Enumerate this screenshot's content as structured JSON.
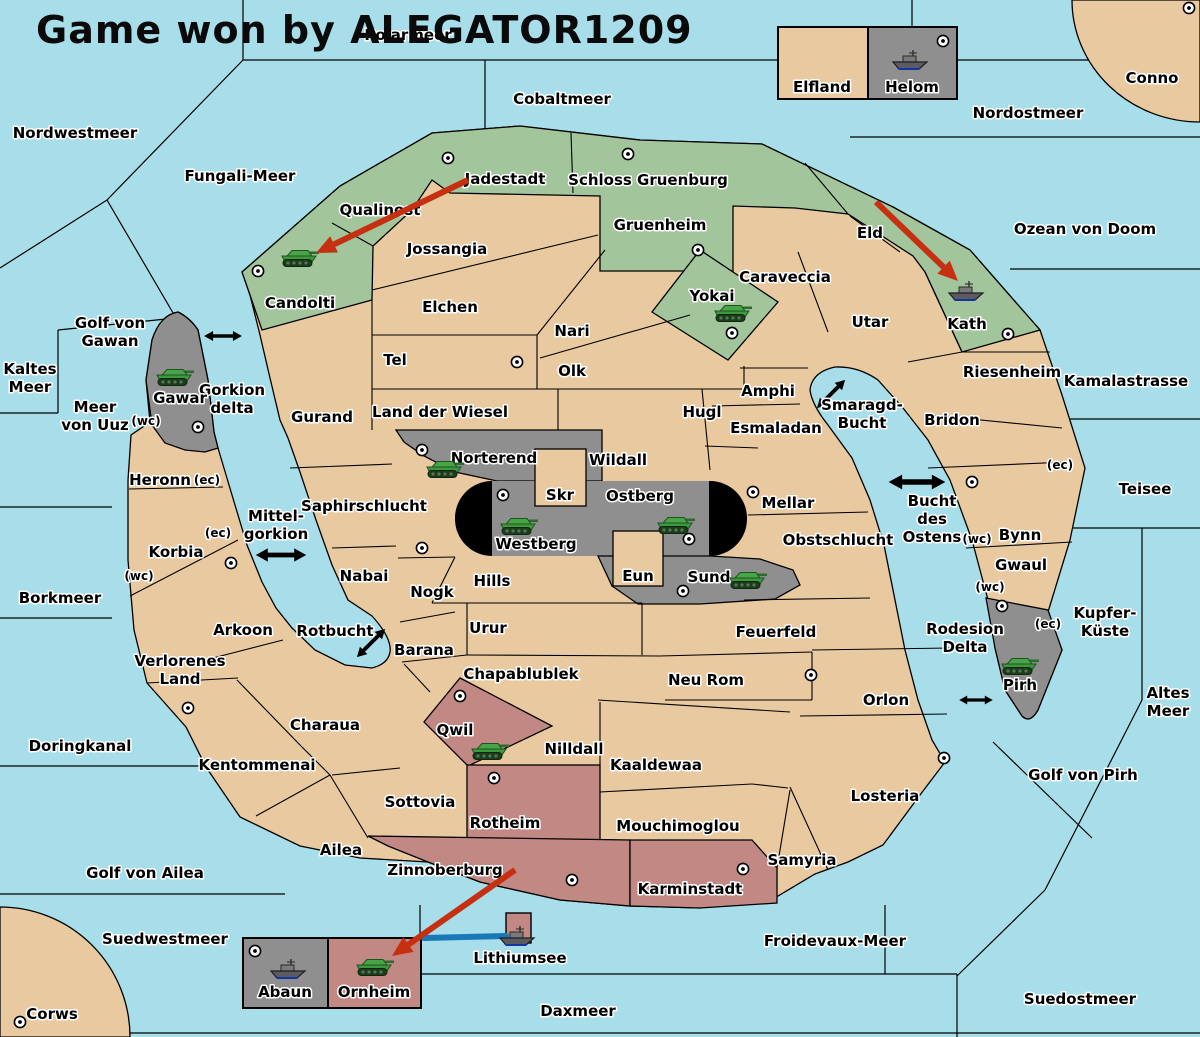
{
  "title": "Game won by ALEGATOR1209",
  "colors": {
    "sea": "#A8DEEA",
    "land": "#E9C9A0",
    "green": "#A2C59C",
    "gray": "#8F8F8F",
    "pink": "#C28884",
    "black_tunnel": "#000000",
    "arrow_red": "#C62F10",
    "link_blue": "#1878B8",
    "border": "#000000"
  },
  "sea_labels": [
    {
      "name": "polarmeer",
      "x": 408,
      "y": 40,
      "lines": [
        "Polarmeer"
      ]
    },
    {
      "name": "nordwestmeer",
      "x": 75,
      "y": 138,
      "lines": [
        "Nordwestmeer"
      ]
    },
    {
      "name": "fungali-meer",
      "x": 240,
      "y": 181,
      "lines": [
        "Fungali-Meer"
      ]
    },
    {
      "name": "cobaltmeer",
      "x": 562,
      "y": 104,
      "lines": [
        "Cobaltmeer"
      ]
    },
    {
      "name": "nordostmeer",
      "x": 1028,
      "y": 118,
      "lines": [
        "Nordostmeer"
      ]
    },
    {
      "name": "conno",
      "x": 1152,
      "y": 83,
      "lines": [
        "Conno"
      ]
    },
    {
      "name": "ozean-von-doom",
      "x": 1085,
      "y": 234,
      "lines": [
        "Ozean von Doom"
      ]
    },
    {
      "name": "kamalastrasse",
      "x": 1126,
      "y": 386,
      "lines": [
        "Kamalastrasse"
      ]
    },
    {
      "name": "teisee",
      "x": 1145,
      "y": 494,
      "lines": [
        "Teisee"
      ]
    },
    {
      "name": "kupfer-kueste",
      "x": 1105,
      "y": 618,
      "lines": [
        "Kupfer-",
        "Küste"
      ]
    },
    {
      "name": "altes-meer",
      "x": 1168,
      "y": 698,
      "lines": [
        "Altes",
        "Meer"
      ]
    },
    {
      "name": "golf-von-pirh",
      "x": 1083,
      "y": 780,
      "lines": [
        "Golf von Pirh"
      ]
    },
    {
      "name": "golf-von-gawan",
      "x": 110,
      "y": 328,
      "lines": [
        "Golf von",
        "Gawan"
      ]
    },
    {
      "name": "kaltes-meer",
      "x": 30,
      "y": 374,
      "lines": [
        "Kaltes",
        "Meer"
      ]
    },
    {
      "name": "meer-von-uuz",
      "x": 95,
      "y": 412,
      "lines": [
        "Meer",
        "von Uuz"
      ]
    },
    {
      "name": "borkmeer",
      "x": 60,
      "y": 603,
      "lines": [
        "Borkmeer"
      ]
    },
    {
      "name": "doringkanal",
      "x": 80,
      "y": 751,
      "lines": [
        "Doringkanal"
      ]
    },
    {
      "name": "golf-von-ailea",
      "x": 145,
      "y": 878,
      "lines": [
        "Golf von Ailea"
      ]
    },
    {
      "name": "suedwestmeer",
      "x": 165,
      "y": 944,
      "lines": [
        "Suedwestmeer"
      ]
    },
    {
      "name": "corws",
      "x": 52,
      "y": 1019,
      "lines": [
        "Corws"
      ]
    },
    {
      "name": "daxmeer",
      "x": 578,
      "y": 1016,
      "lines": [
        "Daxmeer"
      ]
    },
    {
      "name": "suedostmeer",
      "x": 1080,
      "y": 1004,
      "lines": [
        "Suedostmeer"
      ]
    },
    {
      "name": "froidevaux-meer",
      "x": 835,
      "y": 946,
      "lines": [
        "Froidevaux-Meer"
      ]
    },
    {
      "name": "lithiumsee",
      "x": 520,
      "y": 963,
      "lines": [
        "Lithiumsee"
      ]
    },
    {
      "name": "gorkion-delta",
      "x": 232,
      "y": 395,
      "lines": [
        "Gorkion",
        "delta"
      ]
    },
    {
      "name": "mittel-gorkion",
      "x": 276,
      "y": 521,
      "lines": [
        "Mittel-",
        "gorkion"
      ]
    },
    {
      "name": "rotbucht",
      "x": 335,
      "y": 636,
      "lines": [
        "Rotbucht"
      ]
    },
    {
      "name": "smaragd-bucht",
      "x": 862,
      "y": 410,
      "lines": [
        "Smaragd-",
        "Bucht"
      ]
    },
    {
      "name": "bucht-des-ostens",
      "x": 932,
      "y": 506,
      "lines": [
        "Bucht",
        "des",
        "Ostens"
      ]
    },
    {
      "name": "rodesion-delta",
      "x": 965,
      "y": 634,
      "lines": [
        "Rodesion",
        "Delta"
      ]
    }
  ],
  "land_labels": [
    {
      "name": "candolti",
      "x": 300,
      "y": 308,
      "lines": [
        "Candolti"
      ]
    },
    {
      "name": "qualinost",
      "x": 380,
      "y": 215,
      "lines": [
        "Qualinost"
      ]
    },
    {
      "name": "jadestadt",
      "x": 505,
      "y": 184,
      "lines": [
        "Jadestadt"
      ]
    },
    {
      "name": "schloss-gruenburg",
      "x": 648,
      "y": 185,
      "lines": [
        "Schloss Gruenburg"
      ]
    },
    {
      "name": "gruenheim",
      "x": 660,
      "y": 230,
      "lines": [
        "Gruenheim"
      ]
    },
    {
      "name": "yokai",
      "x": 712,
      "y": 301,
      "lines": [
        "Yokai"
      ]
    },
    {
      "name": "eld",
      "x": 870,
      "y": 238,
      "lines": [
        "Eld"
      ]
    },
    {
      "name": "kath",
      "x": 967,
      "y": 329,
      "lines": [
        "Kath"
      ]
    },
    {
      "name": "jossangia",
      "x": 447,
      "y": 254,
      "lines": [
        "Jossangia"
      ]
    },
    {
      "name": "elchen",
      "x": 450,
      "y": 312,
      "lines": [
        "Elchen"
      ]
    },
    {
      "name": "nari",
      "x": 572,
      "y": 336,
      "lines": [
        "Nari"
      ]
    },
    {
      "name": "tel",
      "x": 395,
      "y": 365,
      "lines": [
        "Tel"
      ]
    },
    {
      "name": "olk",
      "x": 572,
      "y": 376,
      "lines": [
        "Olk"
      ]
    },
    {
      "name": "land-der-wiesel",
      "x": 440,
      "y": 417,
      "lines": [
        "Land der Wiesel"
      ]
    },
    {
      "name": "hugl",
      "x": 702,
      "y": 417,
      "lines": [
        "Hugl"
      ]
    },
    {
      "name": "gurand",
      "x": 322,
      "y": 422,
      "lines": [
        "Gurand"
      ]
    },
    {
      "name": "caraveccia",
      "x": 785,
      "y": 282,
      "lines": [
        "Caraveccia"
      ]
    },
    {
      "name": "amphi",
      "x": 768,
      "y": 396,
      "lines": [
        "Amphi"
      ]
    },
    {
      "name": "esmaladan",
      "x": 776,
      "y": 433,
      "lines": [
        "Esmaladan"
      ]
    },
    {
      "name": "utar",
      "x": 870,
      "y": 327,
      "lines": [
        "Utar"
      ]
    },
    {
      "name": "riesenheim",
      "x": 1012,
      "y": 377,
      "lines": [
        "Riesenheim"
      ]
    },
    {
      "name": "bridon",
      "x": 952,
      "y": 425,
      "lines": [
        "Bridon"
      ]
    },
    {
      "name": "gawar",
      "x": 180,
      "y": 403,
      "lines": [
        "Gawar"
      ]
    },
    {
      "name": "heronn",
      "x": 160,
      "y": 485,
      "lines": [
        "Heronn"
      ]
    },
    {
      "name": "saphirschlucht",
      "x": 364,
      "y": 511,
      "lines": [
        "Saphirschlucht"
      ]
    },
    {
      "name": "korbia",
      "x": 176,
      "y": 557,
      "lines": [
        "Korbia"
      ]
    },
    {
      "name": "nabai",
      "x": 364,
      "y": 581,
      "lines": [
        "Nabai"
      ]
    },
    {
      "name": "norterend",
      "x": 494,
      "y": 463,
      "lines": [
        "Norterend"
      ]
    },
    {
      "name": "skr",
      "x": 560,
      "y": 500,
      "lines": [
        "Skr"
      ]
    },
    {
      "name": "wildall",
      "x": 618,
      "y": 465,
      "lines": [
        "Wildall"
      ]
    },
    {
      "name": "ostberg",
      "x": 640,
      "y": 501,
      "lines": [
        "Ostberg"
      ]
    },
    {
      "name": "westberg",
      "x": 536,
      "y": 549,
      "lines": [
        "Westberg"
      ]
    },
    {
      "name": "mellar",
      "x": 788,
      "y": 508,
      "lines": [
        "Mellar"
      ]
    },
    {
      "name": "eun",
      "x": 638,
      "y": 581,
      "lines": [
        "Eun"
      ]
    },
    {
      "name": "sund",
      "x": 709,
      "y": 582,
      "lines": [
        "Sund"
      ]
    },
    {
      "name": "hills",
      "x": 492,
      "y": 586,
      "lines": [
        "Hills"
      ]
    },
    {
      "name": "obstschlucht",
      "x": 838,
      "y": 545,
      "lines": [
        "Obstschlucht"
      ]
    },
    {
      "name": "nogk",
      "x": 432,
      "y": 597,
      "lines": [
        "Nogk"
      ]
    },
    {
      "name": "urur",
      "x": 488,
      "y": 633,
      "lines": [
        "Urur"
      ]
    },
    {
      "name": "barana",
      "x": 424,
      "y": 655,
      "lines": [
        "Barana"
      ]
    },
    {
      "name": "arkoon",
      "x": 243,
      "y": 635,
      "lines": [
        "Arkoon"
      ]
    },
    {
      "name": "verlorenes-land",
      "x": 180,
      "y": 666,
      "lines": [
        "Verlorenes",
        "Land"
      ]
    },
    {
      "name": "feuerfeld",
      "x": 776,
      "y": 637,
      "lines": [
        "Feuerfeld"
      ]
    },
    {
      "name": "chapablublek",
      "x": 521,
      "y": 679,
      "lines": [
        "Chapablublek"
      ]
    },
    {
      "name": "neu-rom",
      "x": 706,
      "y": 685,
      "lines": [
        "Neu Rom"
      ]
    },
    {
      "name": "orlon",
      "x": 886,
      "y": 705,
      "lines": [
        "Orlon"
      ]
    },
    {
      "name": "qwil",
      "x": 455,
      "y": 735,
      "lines": [
        "Qwil"
      ]
    },
    {
      "name": "nilldall",
      "x": 574,
      "y": 754,
      "lines": [
        "Nilldall"
      ]
    },
    {
      "name": "kaaldewaa",
      "x": 656,
      "y": 770,
      "lines": [
        "Kaaldewaa"
      ]
    },
    {
      "name": "charaua",
      "x": 325,
      "y": 730,
      "lines": [
        "Charaua"
      ]
    },
    {
      "name": "kentommenai",
      "x": 257,
      "y": 770,
      "lines": [
        "Kentommenai"
      ]
    },
    {
      "name": "sottovia",
      "x": 420,
      "y": 807,
      "lines": [
        "Sottovia"
      ]
    },
    {
      "name": "rotheim",
      "x": 505,
      "y": 828,
      "lines": [
        "Rotheim"
      ]
    },
    {
      "name": "mouchimoglou",
      "x": 678,
      "y": 831,
      "lines": [
        "Mouchimoglou"
      ]
    },
    {
      "name": "losteria",
      "x": 885,
      "y": 801,
      "lines": [
        "Losteria"
      ]
    },
    {
      "name": "ailea",
      "x": 341,
      "y": 855,
      "lines": [
        "Ailea"
      ]
    },
    {
      "name": "zinnoberburg",
      "x": 445,
      "y": 875,
      "lines": [
        "Zinnoberburg"
      ]
    },
    {
      "name": "karminstadt",
      "x": 690,
      "y": 894,
      "lines": [
        "Karminstadt"
      ]
    },
    {
      "name": "samyria",
      "x": 802,
      "y": 865,
      "lines": [
        "Samyria"
      ]
    },
    {
      "name": "pirh",
      "x": 1020,
      "y": 690,
      "lines": [
        "Pirh"
      ]
    },
    {
      "name": "bynn",
      "x": 1020,
      "y": 540,
      "lines": [
        "Bynn"
      ]
    },
    {
      "name": "gwaul",
      "x": 1021,
      "y": 570,
      "lines": [
        "Gwaul"
      ]
    },
    {
      "name": "elfland",
      "x": 822,
      "y": 92,
      "lines": [
        "Elfland"
      ]
    },
    {
      "name": "helom",
      "x": 912,
      "y": 92,
      "lines": [
        "Helom"
      ]
    },
    {
      "name": "abaun",
      "x": 285,
      "y": 997,
      "lines": [
        "Abaun"
      ]
    },
    {
      "name": "ornheim",
      "x": 374,
      "y": 997,
      "lines": [
        "Ornheim"
      ]
    }
  ],
  "coast_labels": [
    {
      "text": "(wc)",
      "x": 146,
      "y": 425
    },
    {
      "text": "(ec)",
      "x": 207,
      "y": 484
    },
    {
      "text": "(ec)",
      "x": 218,
      "y": 537
    },
    {
      "text": "(wc)",
      "x": 139,
      "y": 580
    },
    {
      "text": "(ec)",
      "x": 1060,
      "y": 469
    },
    {
      "text": "(wc)",
      "x": 977,
      "y": 543
    },
    {
      "text": "(wc)",
      "x": 990,
      "y": 591
    },
    {
      "text": "(ec)",
      "x": 1048,
      "y": 628
    }
  ],
  "supply_centers": [
    {
      "region": "jadestadt",
      "x": 448,
      "y": 158
    },
    {
      "region": "schloss-gruenburg",
      "x": 628,
      "y": 154
    },
    {
      "region": "gruenheim",
      "x": 698,
      "y": 250
    },
    {
      "region": "yokai",
      "x": 732,
      "y": 333
    },
    {
      "region": "kath",
      "x": 1008,
      "y": 334
    },
    {
      "region": "candolti",
      "x": 258,
      "y": 271
    },
    {
      "region": "conno",
      "x": 1189,
      "y": 8
    },
    {
      "region": "helom",
      "x": 943,
      "y": 41
    },
    {
      "region": "tel",
      "x": 517,
      "y": 362
    },
    {
      "region": "gawar",
      "x": 198,
      "y": 427
    },
    {
      "region": "korbia",
      "x": 231,
      "y": 563
    },
    {
      "region": "kentommenai",
      "x": 188,
      "y": 708
    },
    {
      "region": "norterend",
      "x": 422,
      "y": 450
    },
    {
      "region": "westberg",
      "x": 503,
      "y": 495
    },
    {
      "region": "ostberg",
      "x": 689,
      "y": 539
    },
    {
      "region": "mellar",
      "x": 753,
      "y": 492
    },
    {
      "region": "sund",
      "x": 683,
      "y": 591
    },
    {
      "region": "nabai",
      "x": 422,
      "y": 548
    },
    {
      "region": "qwil",
      "x": 460,
      "y": 696
    },
    {
      "region": "rotheim",
      "x": 494,
      "y": 778
    },
    {
      "region": "zinnoberburg",
      "x": 572,
      "y": 880
    },
    {
      "region": "karminstadt",
      "x": 743,
      "y": 869
    },
    {
      "region": "neu-rom",
      "x": 811,
      "y": 675
    },
    {
      "region": "losteria",
      "x": 944,
      "y": 758
    },
    {
      "region": "bynn",
      "x": 972,
      "y": 482
    },
    {
      "region": "pirh",
      "x": 1002,
      "y": 606
    },
    {
      "region": "abaun",
      "x": 255,
      "y": 951
    },
    {
      "region": "corws",
      "x": 20,
      "y": 1022
    }
  ],
  "units": [
    {
      "type": "tank",
      "region": "candolti",
      "x": 300,
      "y": 257
    },
    {
      "type": "tank",
      "region": "gawar",
      "x": 175,
      "y": 376
    },
    {
      "type": "tank",
      "region": "yokai",
      "x": 733,
      "y": 312
    },
    {
      "type": "tank",
      "region": "norterend",
      "x": 445,
      "y": 468
    },
    {
      "type": "tank",
      "region": "westberg",
      "x": 519,
      "y": 525
    },
    {
      "type": "tank",
      "region": "ostberg",
      "x": 676,
      "y": 524
    },
    {
      "type": "tank",
      "region": "sund",
      "x": 748,
      "y": 579
    },
    {
      "type": "tank",
      "region": "qwil",
      "x": 490,
      "y": 750
    },
    {
      "type": "tank",
      "region": "pirh",
      "x": 1020,
      "y": 665
    },
    {
      "type": "tank",
      "region": "ornheim",
      "x": 375,
      "y": 966
    },
    {
      "type": "ship",
      "region": "helom",
      "x": 910,
      "y": 60
    },
    {
      "type": "ship",
      "region": "kath",
      "x": 966,
      "y": 291
    },
    {
      "type": "ship",
      "region": "abaun",
      "x": 288,
      "y": 969
    },
    {
      "type": "ship",
      "region": "lithiumsee",
      "x": 517,
      "y": 936
    }
  ],
  "attack_arrows": [
    {
      "name": "arrow-qualinost-candolti",
      "from": [
        468,
        180
      ],
      "to": [
        316,
        253
      ]
    },
    {
      "name": "arrow-eld-kath",
      "from": [
        876,
        202
      ],
      "to": [
        958,
        281
      ]
    },
    {
      "name": "arrow-zinnoberburg-ornheim",
      "from": [
        515,
        870
      ],
      "to": [
        392,
        956
      ]
    }
  ],
  "strait_arrows": [
    {
      "name": "strait-gorkion-delta",
      "x": 223,
      "y": 336,
      "rot": 0,
      "scale": 0.9
    },
    {
      "name": "strait-mittel-gorkion",
      "x": 281,
      "y": 555,
      "rot": 0,
      "scale": 1.2
    },
    {
      "name": "strait-rotbucht",
      "x": 371,
      "y": 643,
      "rot": -45,
      "scale": 0.95
    },
    {
      "name": "strait-smaragd-bucht",
      "x": 831,
      "y": 394,
      "rot": -45,
      "scale": 0.95
    },
    {
      "name": "strait-bucht-des-ostens",
      "x": 917,
      "y": 482,
      "rot": 0,
      "scale": 1.35
    },
    {
      "name": "strait-rodesion-delta",
      "x": 976,
      "y": 700,
      "rot": 0,
      "scale": 0.8
    }
  ],
  "sea_link": {
    "name": "link-ornheim-lithiumsee",
    "from": [
      424,
      938
    ],
    "to": [
      506,
      936
    ]
  }
}
